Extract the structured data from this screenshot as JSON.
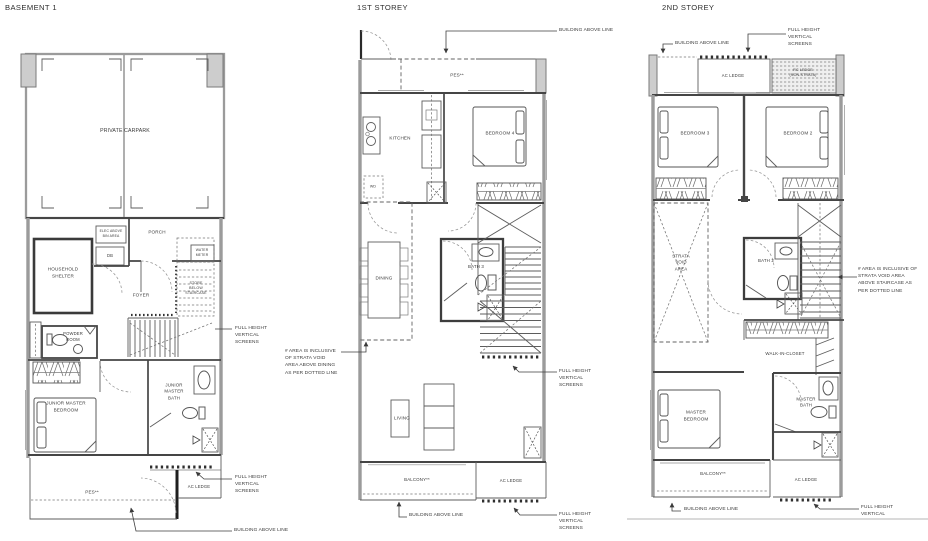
{
  "colors": {
    "background": "#ffffff",
    "wall_gray": "#9b9b9b",
    "wall_dark": "#454545",
    "pier_fill": "#cdcdcd",
    "text": "#3a3a3a",
    "screen_dots": "#2e2e2e",
    "page_edge": "#c4c4c4"
  },
  "panels": {
    "basement": {
      "title": "BASEMENT 1",
      "labels": {
        "carpark": "PRIVATE CARPARK",
        "elec": "ELEC ABOVE\nBIN AREA",
        "db": "DB",
        "porch": "PORCH",
        "water_meter": "WATER\nMETER",
        "household_shelter": "HOUSEHOLD\nSHELTER",
        "foyer": "FOYER",
        "store": "STORE\nBELOW\nSTAIRCASE",
        "powder_room": "POWDER\nROOM",
        "junior_master_bedroom": "JUNIOR MASTER\nBEDROOM",
        "junior_master_bath": "JUNIOR\nMASTER\nBATH",
        "ac_ledge": "AC LEDGE",
        "pes": "PES**"
      },
      "annotations": {
        "screens_mid": "FULL HEIGHT\nVERTICAL\nSCREENS",
        "screens_low": "FULL HEIGHT\nVERTICAL\nSCREENS",
        "building_above": "BUILDING ABOVE LINE"
      }
    },
    "first": {
      "title": "1ST STOREY",
      "labels": {
        "pes": "PES**",
        "kitchen": "KITCHEN",
        "bedroom4": "BEDROOM 4",
        "wd": "WD",
        "dining": "DINING",
        "bath3": "BATH 3",
        "living": "LIVING",
        "balcony": "BALCONY**",
        "ac_ledge": "AC LEDGE"
      },
      "annotations": {
        "building_above_top": "BUILDING ABOVE LINE",
        "strata_void_note": "# AREA IS INCLUSIVE\nOF STRATA VOID\nAREA ABOVE DINING\nAS PER DOTTED LINE",
        "screens_mid": "FULL HEIGHT\nVERTICAL\nSCREENS",
        "building_above_bottom": "BUILDING ABOVE LINE",
        "screens_low": "FULL HEIGHT\nVERTICAL\nSCREENS"
      }
    },
    "second": {
      "title": "2ND STOREY",
      "labels": {
        "ac_ledge_top": "AC LEDGE",
        "rc_ledge": "RC LEDGE\n(NON-STRATA)",
        "bedroom3": "BEDROOM 3",
        "bedroom2": "BEDROOM 2",
        "strata_void": "STRATA\nVOID\nAREA",
        "bath2": "BATH 2",
        "walk_in_closet": "WALK-IN-CLOSET",
        "master_bedroom": "MASTER\nBEDROOM",
        "master_bath": "MASTER\nBATH",
        "balcony": "BALCONY**",
        "ac_ledge_bottom": "AC LEDGE"
      },
      "annotations": {
        "building_above_top": "BUILDING ABOVE LINE",
        "screens_top": "FULL HEIGHT\nVERTICAL\nSCREENS",
        "strata_void_note": "# AREA IS INCLUSIVE OF\nSTRATA VOID AREA\nABOVE STAIRCASE AS\nPER DOTTED LINE",
        "building_above_bottom": "BUILDING ABOVE LINE",
        "screens_bottom": "FULL HEIGHT\nVERTICAL"
      }
    }
  }
}
